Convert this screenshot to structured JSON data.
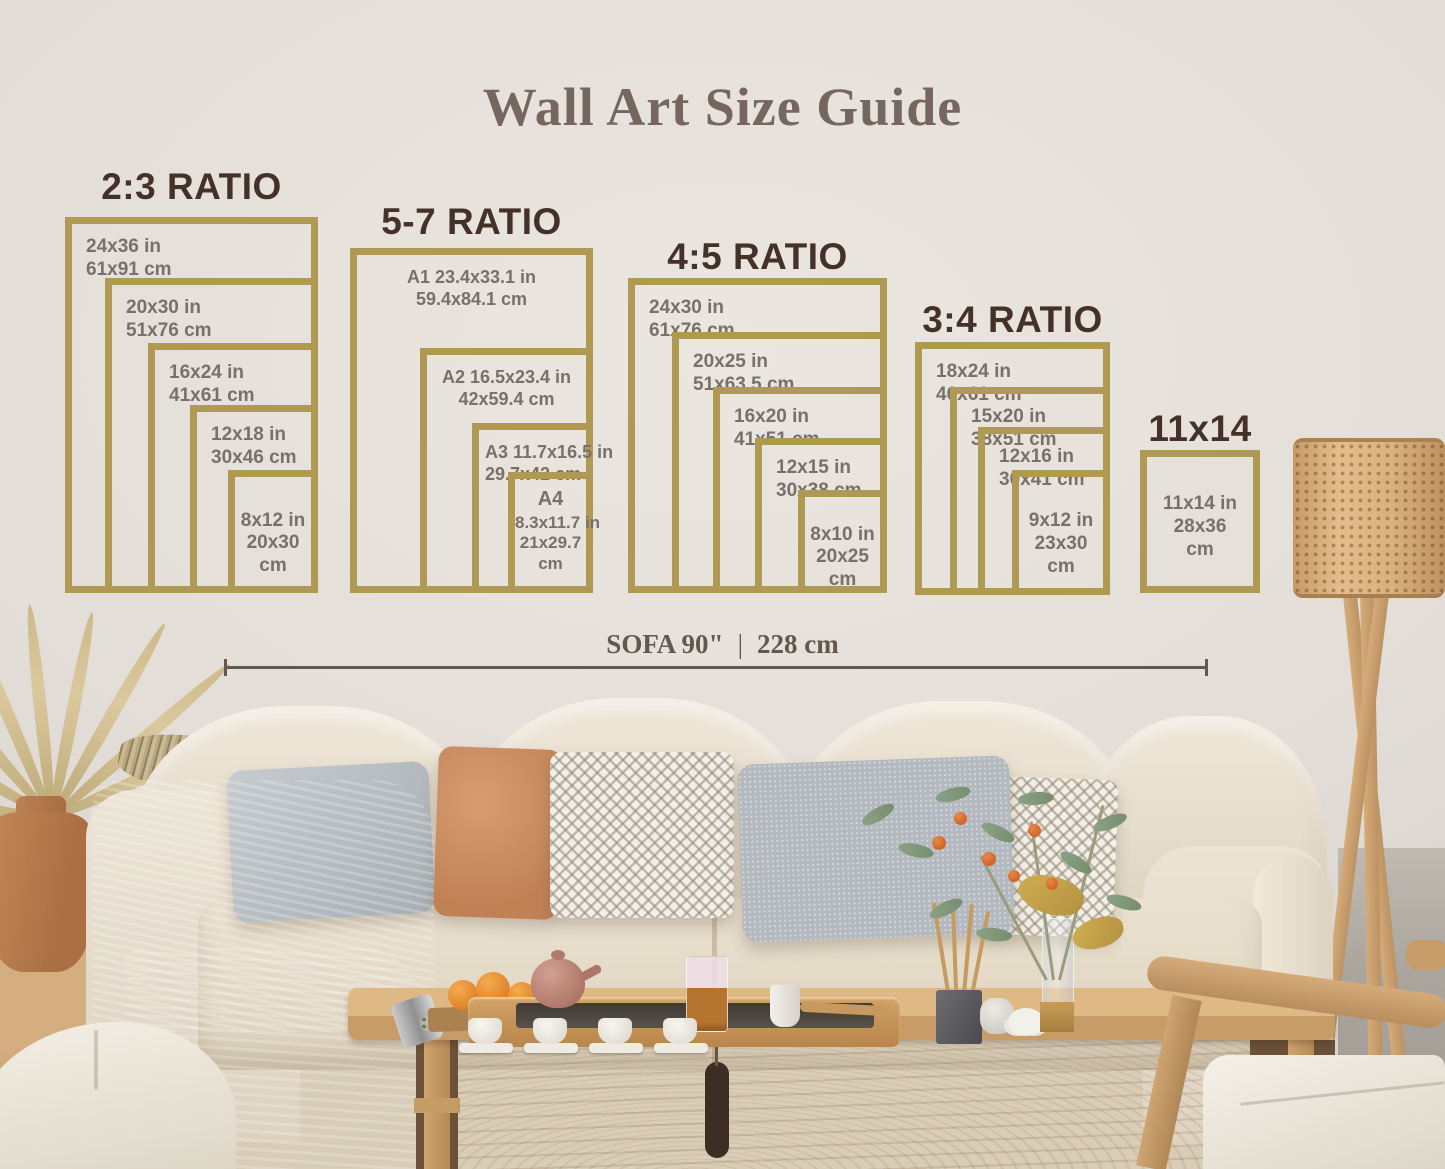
{
  "title": "Wall Art Size Guide",
  "groups": [
    {
      "heading": "2:3 RATIO",
      "frames": [
        {
          "line1": "24x36 in",
          "line2": "61x91 cm"
        },
        {
          "line1": "20x30 in",
          "line2": "51x76 cm"
        },
        {
          "line1": "16x24 in",
          "line2": "41x61 cm"
        },
        {
          "line1": "12x18 in",
          "line2": "30x46 cm"
        },
        {
          "line1": "8x12 in",
          "line2": "20x30",
          "line3": "cm"
        }
      ]
    },
    {
      "heading": "5-7 RATIO",
      "frames": [
        {
          "line1": "A1 23.4x33.1 in",
          "line2": "59.4x84.1 cm"
        },
        {
          "line1": "A2 16.5x23.4 in",
          "line2": "42x59.4 cm"
        },
        {
          "line1": "A3 11.7x16.5 in",
          "line2": "29.7x42 cm"
        },
        {
          "line1": "A4",
          "line2": "8.3x11.7 in",
          "line3": "21x29.7",
          "line4": "cm"
        }
      ]
    },
    {
      "heading": "4:5 RATIO",
      "frames": [
        {
          "line1": "24x30 in",
          "line2": "61x76 cm"
        },
        {
          "line1": "20x25 in",
          "line2": "51x63.5 cm"
        },
        {
          "line1": "16x20 in",
          "line2": "41x51 cm"
        },
        {
          "line1": "12x15 in",
          "line2": "30x38 cm"
        },
        {
          "line1": "8x10 in",
          "line2": "20x25",
          "line3": "cm"
        }
      ]
    },
    {
      "heading": "3:4 RATIO",
      "frames": [
        {
          "line1": "18x24 in",
          "line2": "46x61 cm"
        },
        {
          "line1": "15x20 in",
          "line2": "38x51 cm"
        },
        {
          "line1": "12x16 in",
          "line2": "30x41 cm"
        },
        {
          "line1": "9x12 in",
          "line2": "23x30",
          "line3": "cm"
        }
      ]
    },
    {
      "heading": "11x14",
      "frames": [
        {
          "line1": "11x14 in",
          "line2": "28x36",
          "line3": "cm"
        }
      ]
    }
  ],
  "measure": {
    "imperial": "SOFA 90\"",
    "divider": "|",
    "metric": "228 cm"
  },
  "colors": {
    "frame_gold": "#b09952",
    "heading_brown": "#44322a",
    "label_gray": "#78706a",
    "title_brown": "#75665f",
    "measure_brown": "#64584e"
  }
}
